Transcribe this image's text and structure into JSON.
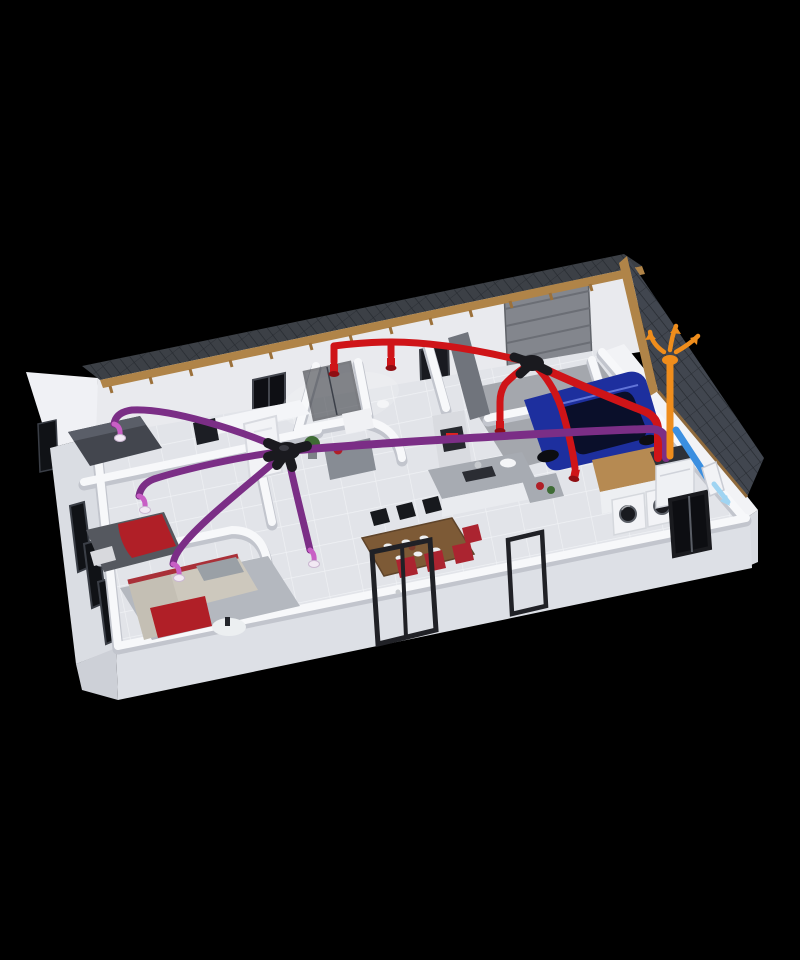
{
  "scene": {
    "type": "3d-cutaway-architectural-render",
    "subject": "Dollhouse cutaway of a single-storey house on a black background showing a dual-flow heat-recovery ventilation duct system",
    "camera": "high-angle isometric view from the front-left",
    "background_color": "#000000"
  },
  "exterior": {
    "roof": "dark tiled gable roof on the right end plus a narrow rear roof slope with timber fascia and rafter tails",
    "walls": "white rendered walls, front walls cut away to reveal interior",
    "openings": [
      "rear-window",
      "rear-interior-door",
      "sectional-garage-door",
      "front-glazed-door-frames",
      "east-window",
      "west-gable-window",
      "west-glazing-panels"
    ]
  },
  "rooms": [
    {
      "id": "bedroom-1",
      "position": "north-west",
      "furniture": [
        "dark-double-bed",
        "dark-wall-panel"
      ],
      "ventilation": "purple supply diffuser"
    },
    {
      "id": "bedroom-2",
      "position": "west",
      "furniture": [
        "bed-with-red-blanket",
        "pillows"
      ],
      "ventilation": "purple supply diffuser"
    },
    {
      "id": "living-room",
      "position": "south-west",
      "furniture": [
        "corner-sofa-with-red-trim",
        "red-throw",
        "round-coffee-table",
        "grey-rug"
      ],
      "ventilation": "two purple supply diffusers"
    },
    {
      "id": "hallway",
      "position": "center-west",
      "furniture": [
        "white-interior-door",
        "potted-plant"
      ],
      "ventilation": "ceiling supply distribution hub"
    },
    {
      "id": "bathroom",
      "position": "north-center",
      "furniture": [
        "walk-in-shower",
        "vanity-cabinet",
        "red-bowl",
        "toilet"
      ],
      "ventilation": "red extract vent"
    },
    {
      "id": "wc",
      "position": "north-center-east",
      "furniture": [
        "toilet"
      ],
      "ventilation": "red extract vent"
    },
    {
      "id": "kitchen",
      "position": "center",
      "furniture": [
        "grey-counter-run",
        "tall-oven-column",
        "cooktop",
        "sink",
        "red-pot",
        "plant"
      ],
      "ventilation": "red extract vent"
    },
    {
      "id": "dining-area",
      "position": "south-center",
      "furniture": [
        "rustic-wood-table",
        "black-chairs",
        "red-chairs",
        "table-settings"
      ],
      "ventilation": "purple supply diffuser nearby"
    },
    {
      "id": "garage",
      "position": "north-east",
      "furniture": [
        "dark-blue-car",
        "sectional-garage-door",
        "concrete-floor"
      ]
    },
    {
      "id": "utility-room",
      "position": "east",
      "furniture": [
        "washing-machine",
        "dryer",
        "wood-front-cabinets",
        "heat-recovery-unit"
      ],
      "ventilation": "red extract drop"
    }
  ],
  "ventilation": {
    "system": "dual-flow heat-recovery ventilation (VMC double flux)",
    "supply": {
      "color_key": "duct_supply",
      "hub": "black ceiling distribution hub above the hallway",
      "outlets": [
        "bedroom-1",
        "bedroom-2",
        "living-room-west",
        "living-dining"
      ],
      "diffuser_style": "white ceiling diffuser with magenta collar"
    },
    "extract": {
      "color_key": "duct_extract",
      "manifold": "black extract manifold above the garage partition wall",
      "inlets": [
        "bathroom-shower",
        "wc",
        "kitchen",
        "utility-room"
      ],
      "vent_style": "red cylindrical extract valve"
    },
    "exhaust": {
      "color_key": "duct_exhaust",
      "route": "vertical duct from heat-recovery unit up through the tiled roof",
      "termination": "roof cowl with orange outward airflow arrows"
    },
    "intake": {
      "color_key": "duct_intake",
      "route": "diagonal duct from heat-recovery unit through the east wall",
      "termination": "exterior wall inlet with light-blue airflow arrow"
    },
    "unit": {
      "name": "heat-recovery-unit",
      "location": "utility-room",
      "body": "white cabinet with dark top manifold"
    }
  },
  "colors": {
    "background": "#000000",
    "roof_tiles": "#41464f",
    "roof_tile_lines": "#262a30",
    "roof_strip": "#3c4046",
    "wood_fascia": "#b08448",
    "wall_white": "#f7f8fa",
    "wall_shadow": "#c2c5cd",
    "wall_back": "#e9eaee",
    "floor_tile": "#e2e4e9",
    "floor_line": "#f0f2f5",
    "garage_floor": "#a4a7ad",
    "slab": "#dde0e6",
    "duct_supply": "#7b2e86",
    "duct_supply_diffuser": "#c85fc5",
    "duct_extract": "#cf1418",
    "duct_exhaust": "#ef8d1c",
    "duct_intake": "#3b8fe0",
    "duct_intake_light": "#9fd4f2",
    "hub_black": "#1a1a1f",
    "car_body": "#1d2f9e",
    "car_glass": "#0a0f2a",
    "accent_red": "#b01f27",
    "sofa": "#cdc8bd",
    "bed_dark": "#43464e",
    "wood_table": "#7d5a36",
    "chair_black": "#17191d",
    "chair_red": "#ab2430",
    "counter_gray": "#a7abb2",
    "cabinet_wood": "#b68a52",
    "appliance_white": "#f2f3f6",
    "glass_dark": "#101216"
  }
}
